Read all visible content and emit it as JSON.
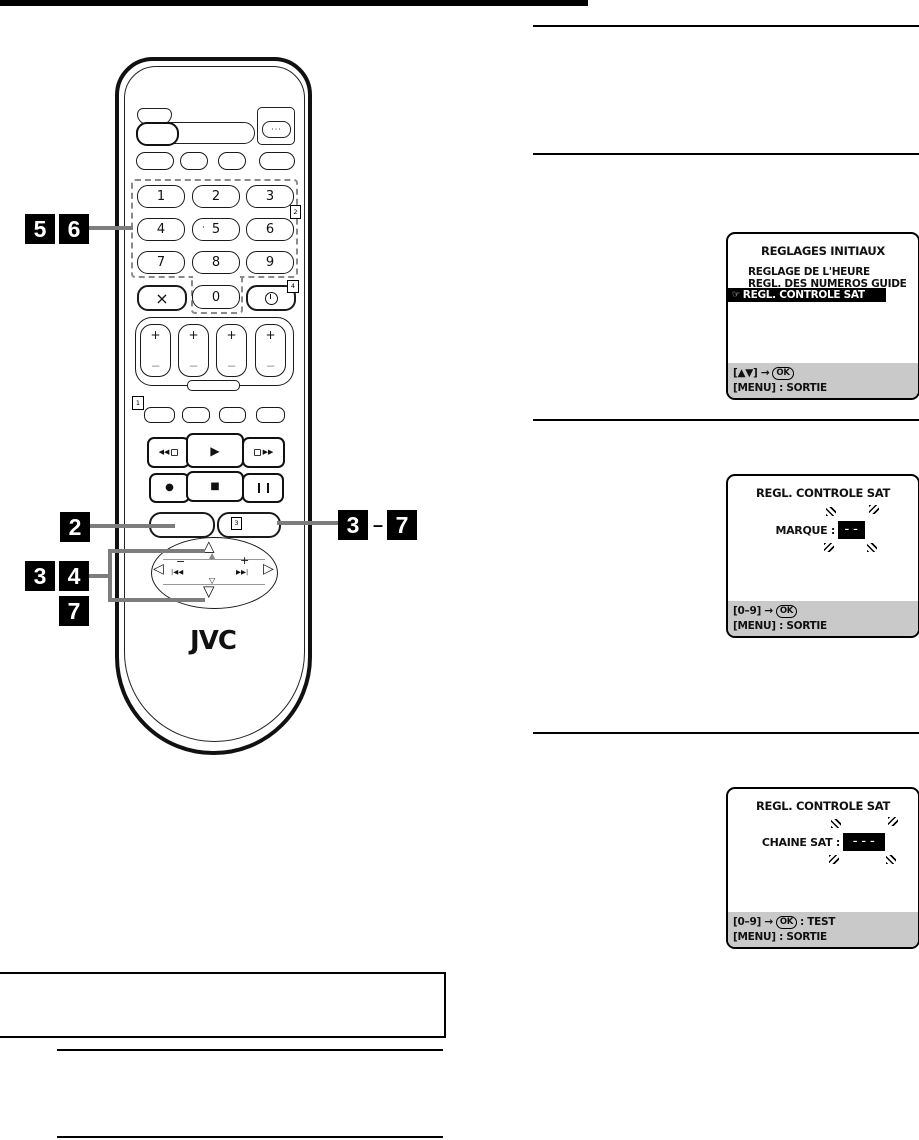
{
  "logo": "JVC",
  "remote": {
    "digits": [
      "1",
      "2",
      "3",
      "4",
      "5",
      "6",
      "7",
      "8",
      "9"
    ],
    "zero": "0",
    "key5_dot": "·",
    "cancel": "×",
    "dots_button": "···",
    "plus": "+",
    "minus": "−",
    "transport": {
      "rewind": "◀◀",
      "play": "▶",
      "forward": "▶▶",
      "record": "●",
      "stop": "■",
      "pause": "❚❚"
    },
    "nav": {
      "up": "△",
      "up_fill": "▲",
      "down_small": "▽",
      "down": "▽",
      "left": "◁",
      "right": "▷",
      "minus": "−",
      "plus": "+",
      "skip_back": "|◀◀",
      "skip_fwd": "▶▶|"
    },
    "markers": {
      "m1": "1",
      "m2": "2",
      "m3": "3",
      "m4": "4"
    }
  },
  "callouts": {
    "c5": "5",
    "c6": "6",
    "c2": "2",
    "c3": "3",
    "c4": "4",
    "c7": "7",
    "c3b": "3",
    "dash": "–",
    "c7b": "7"
  },
  "screens": [
    {
      "title": "REGLAGES INITIAUX",
      "item1": "REGLAGE DE L'HEURE",
      "item2": "REGL. DES NUMEROS GUIDE",
      "hand_icon": "☞",
      "selected": "REGL. CONTROLE SAT",
      "footer1_prefix": "[▲▼] →",
      "footer1_key": "OK",
      "footer1_suffix": "",
      "footer2": "[MENU] : SORTIE"
    },
    {
      "title": "REGL. CONTROLE SAT",
      "label": "MARQUE :",
      "value": "– –",
      "footer1_prefix": "[0–9] →",
      "footer1_key": "OK",
      "footer1_suffix": "",
      "footer2": "[MENU] : SORTIE"
    },
    {
      "title": "REGL. CONTROLE SAT",
      "label": "CHAINE SAT :",
      "value": "– – –",
      "footer1_prefix": "[0–9] →",
      "footer1_key": "OK",
      "footer1_suffix": ": TEST",
      "footer2": "[MENU] : SORTIE"
    }
  ],
  "colors": {
    "highlight_bg": "#000000",
    "footer_bg": "#c9c9c9",
    "connector_gray": "#7d7d7d",
    "dashed_gray": "#8a8a8a"
  }
}
